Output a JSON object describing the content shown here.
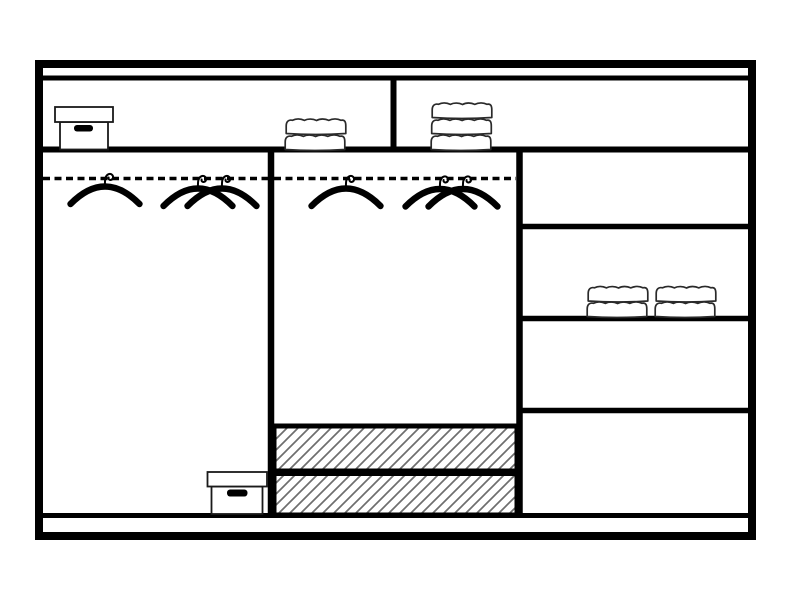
{
  "diagram": {
    "kind": "wardrobe-interior-schematic",
    "style": "black line drawing on white background, no text",
    "colors": {
      "background": "#ffffff",
      "outline": "#000000",
      "detail_outline": "#2a2a2a",
      "hatch": "#6e6e6e"
    },
    "top_shelf": {
      "divided_into_sections": 2,
      "left_section_items": [
        {
          "type": "storage-box",
          "lid": true,
          "handle": true
        },
        {
          "type": "folded-towel-stack",
          "layers": 2
        }
      ],
      "right_section_items": [
        {
          "type": "folded-towel-stack",
          "layers": 3
        }
      ]
    },
    "left_compartment": {
      "rail": "dashed-hanging-rail",
      "hangers": 3,
      "hanger_grouping": "one single, two overlapping",
      "items": [
        {
          "type": "storage-box",
          "lid": true,
          "handle": true,
          "position": "bottom-right"
        }
      ]
    },
    "middle_compartment": {
      "rail": "dashed-hanging-rail",
      "hangers": 3,
      "hanger_grouping": "one single, two overlapping",
      "drawers": [
        {
          "fill": "diagonal-hatch"
        },
        {
          "fill": "diagonal-hatch"
        }
      ]
    },
    "right_column": {
      "shelf_sections": 4,
      "items": [
        {
          "type": "folded-towel-stack",
          "layers": 2
        },
        {
          "type": "folded-towel-stack",
          "layers": 2
        }
      ]
    },
    "totals": {
      "hangers": 6,
      "storage_boxes": 2,
      "towel_stacks": 4,
      "hatched_drawers": 2,
      "shelves_right_column": 4
    }
  }
}
